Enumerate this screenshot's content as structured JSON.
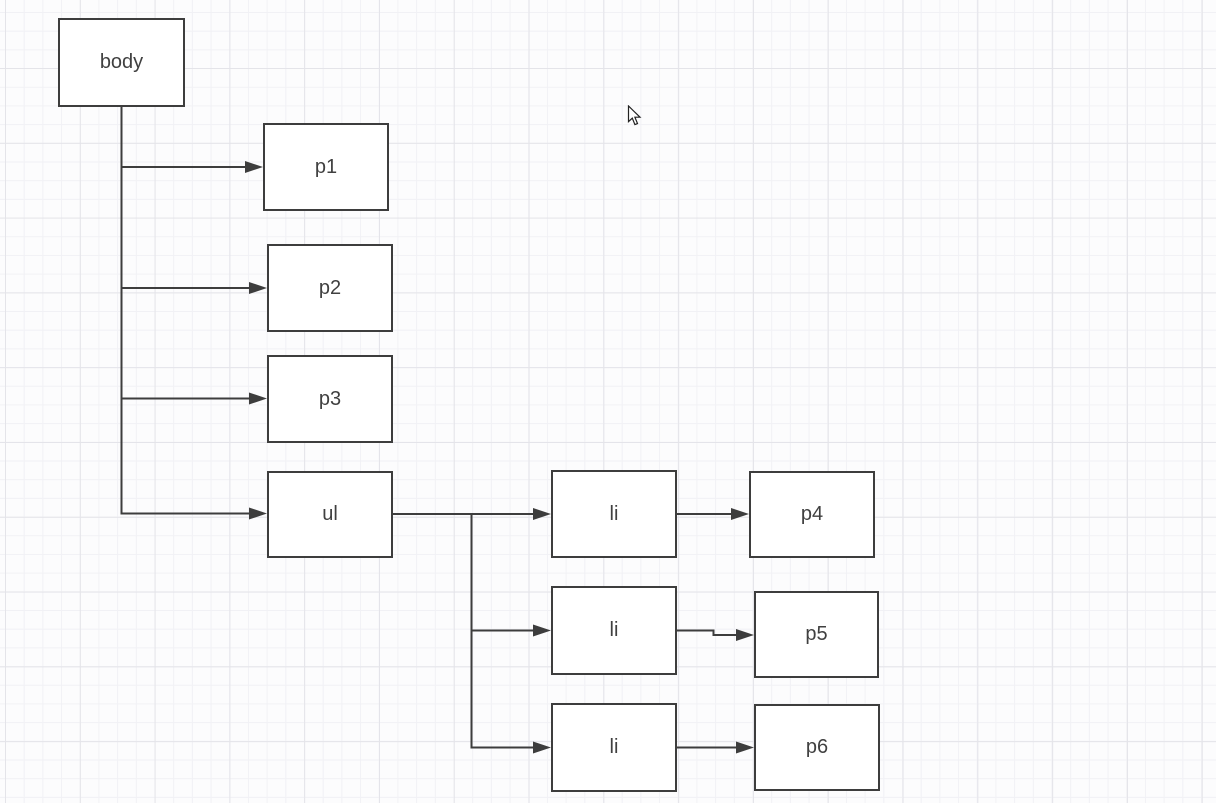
{
  "canvas": {
    "kind": "diagram-grid-canvas",
    "background_color": "#fcfcfd",
    "grid_minor_color": "#f1f1f5",
    "grid_major_color": "#e4e4e9",
    "shape_stroke_color": "#3d3d3d",
    "shape_fill_color": "#ffffff",
    "text_color": "#404040"
  },
  "nodes": [
    {
      "id": "body",
      "label": "body"
    },
    {
      "id": "p1",
      "label": "p1"
    },
    {
      "id": "p2",
      "label": "p2"
    },
    {
      "id": "p3",
      "label": "p3"
    },
    {
      "id": "ul",
      "label": "ul"
    },
    {
      "id": "li-1",
      "label": "li"
    },
    {
      "id": "li-2",
      "label": "li"
    },
    {
      "id": "li-3",
      "label": "li"
    },
    {
      "id": "p4",
      "label": "p4"
    },
    {
      "id": "p5",
      "label": "p5"
    },
    {
      "id": "p6",
      "label": "p6"
    }
  ],
  "edges": [
    {
      "from": "body",
      "to": "p1"
    },
    {
      "from": "body",
      "to": "p2"
    },
    {
      "from": "body",
      "to": "p3"
    },
    {
      "from": "body",
      "to": "ul"
    },
    {
      "from": "ul",
      "to": "li-1"
    },
    {
      "from": "ul",
      "to": "li-2"
    },
    {
      "from": "ul",
      "to": "li-3"
    },
    {
      "from": "li-1",
      "to": "p4"
    },
    {
      "from": "li-2",
      "to": "p5"
    },
    {
      "from": "li-3",
      "to": "p6"
    }
  ],
  "cursor": {
    "type": "arrow-pointer"
  }
}
